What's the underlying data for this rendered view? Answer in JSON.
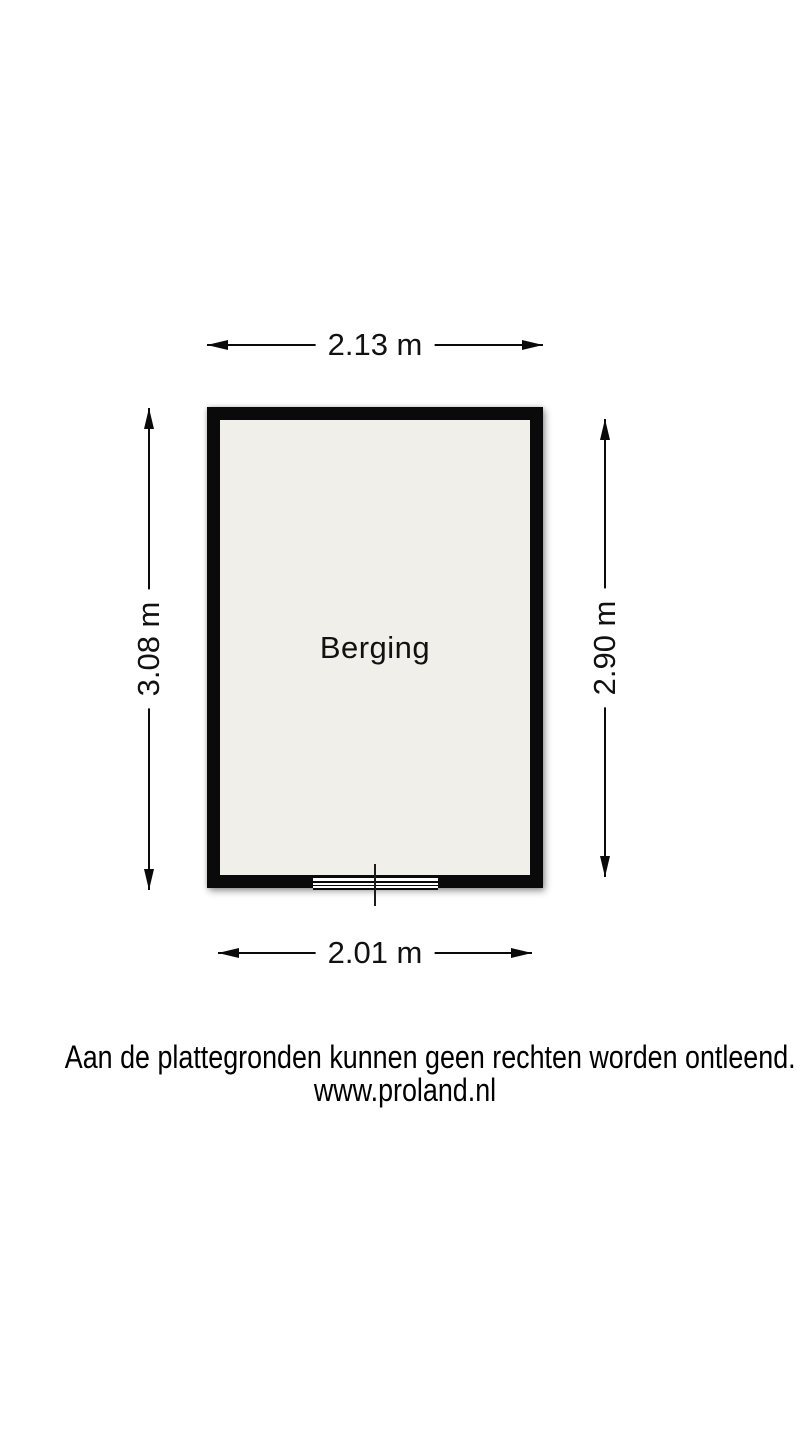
{
  "floorplan": {
    "room_label": "Berging",
    "dimensions": {
      "top": "2.13 m",
      "bottom": "2.01 m",
      "left": "3.08 m",
      "right": "2.90 m"
    },
    "footer": {
      "line1": "Aan de plattegronden kunnen geen rechten worden ontleend.",
      "line2": "www.proland.nl"
    },
    "colors": {
      "wall": "#0a0a0a",
      "room_fill": "#f0efe9",
      "background": "#ffffff"
    }
  }
}
